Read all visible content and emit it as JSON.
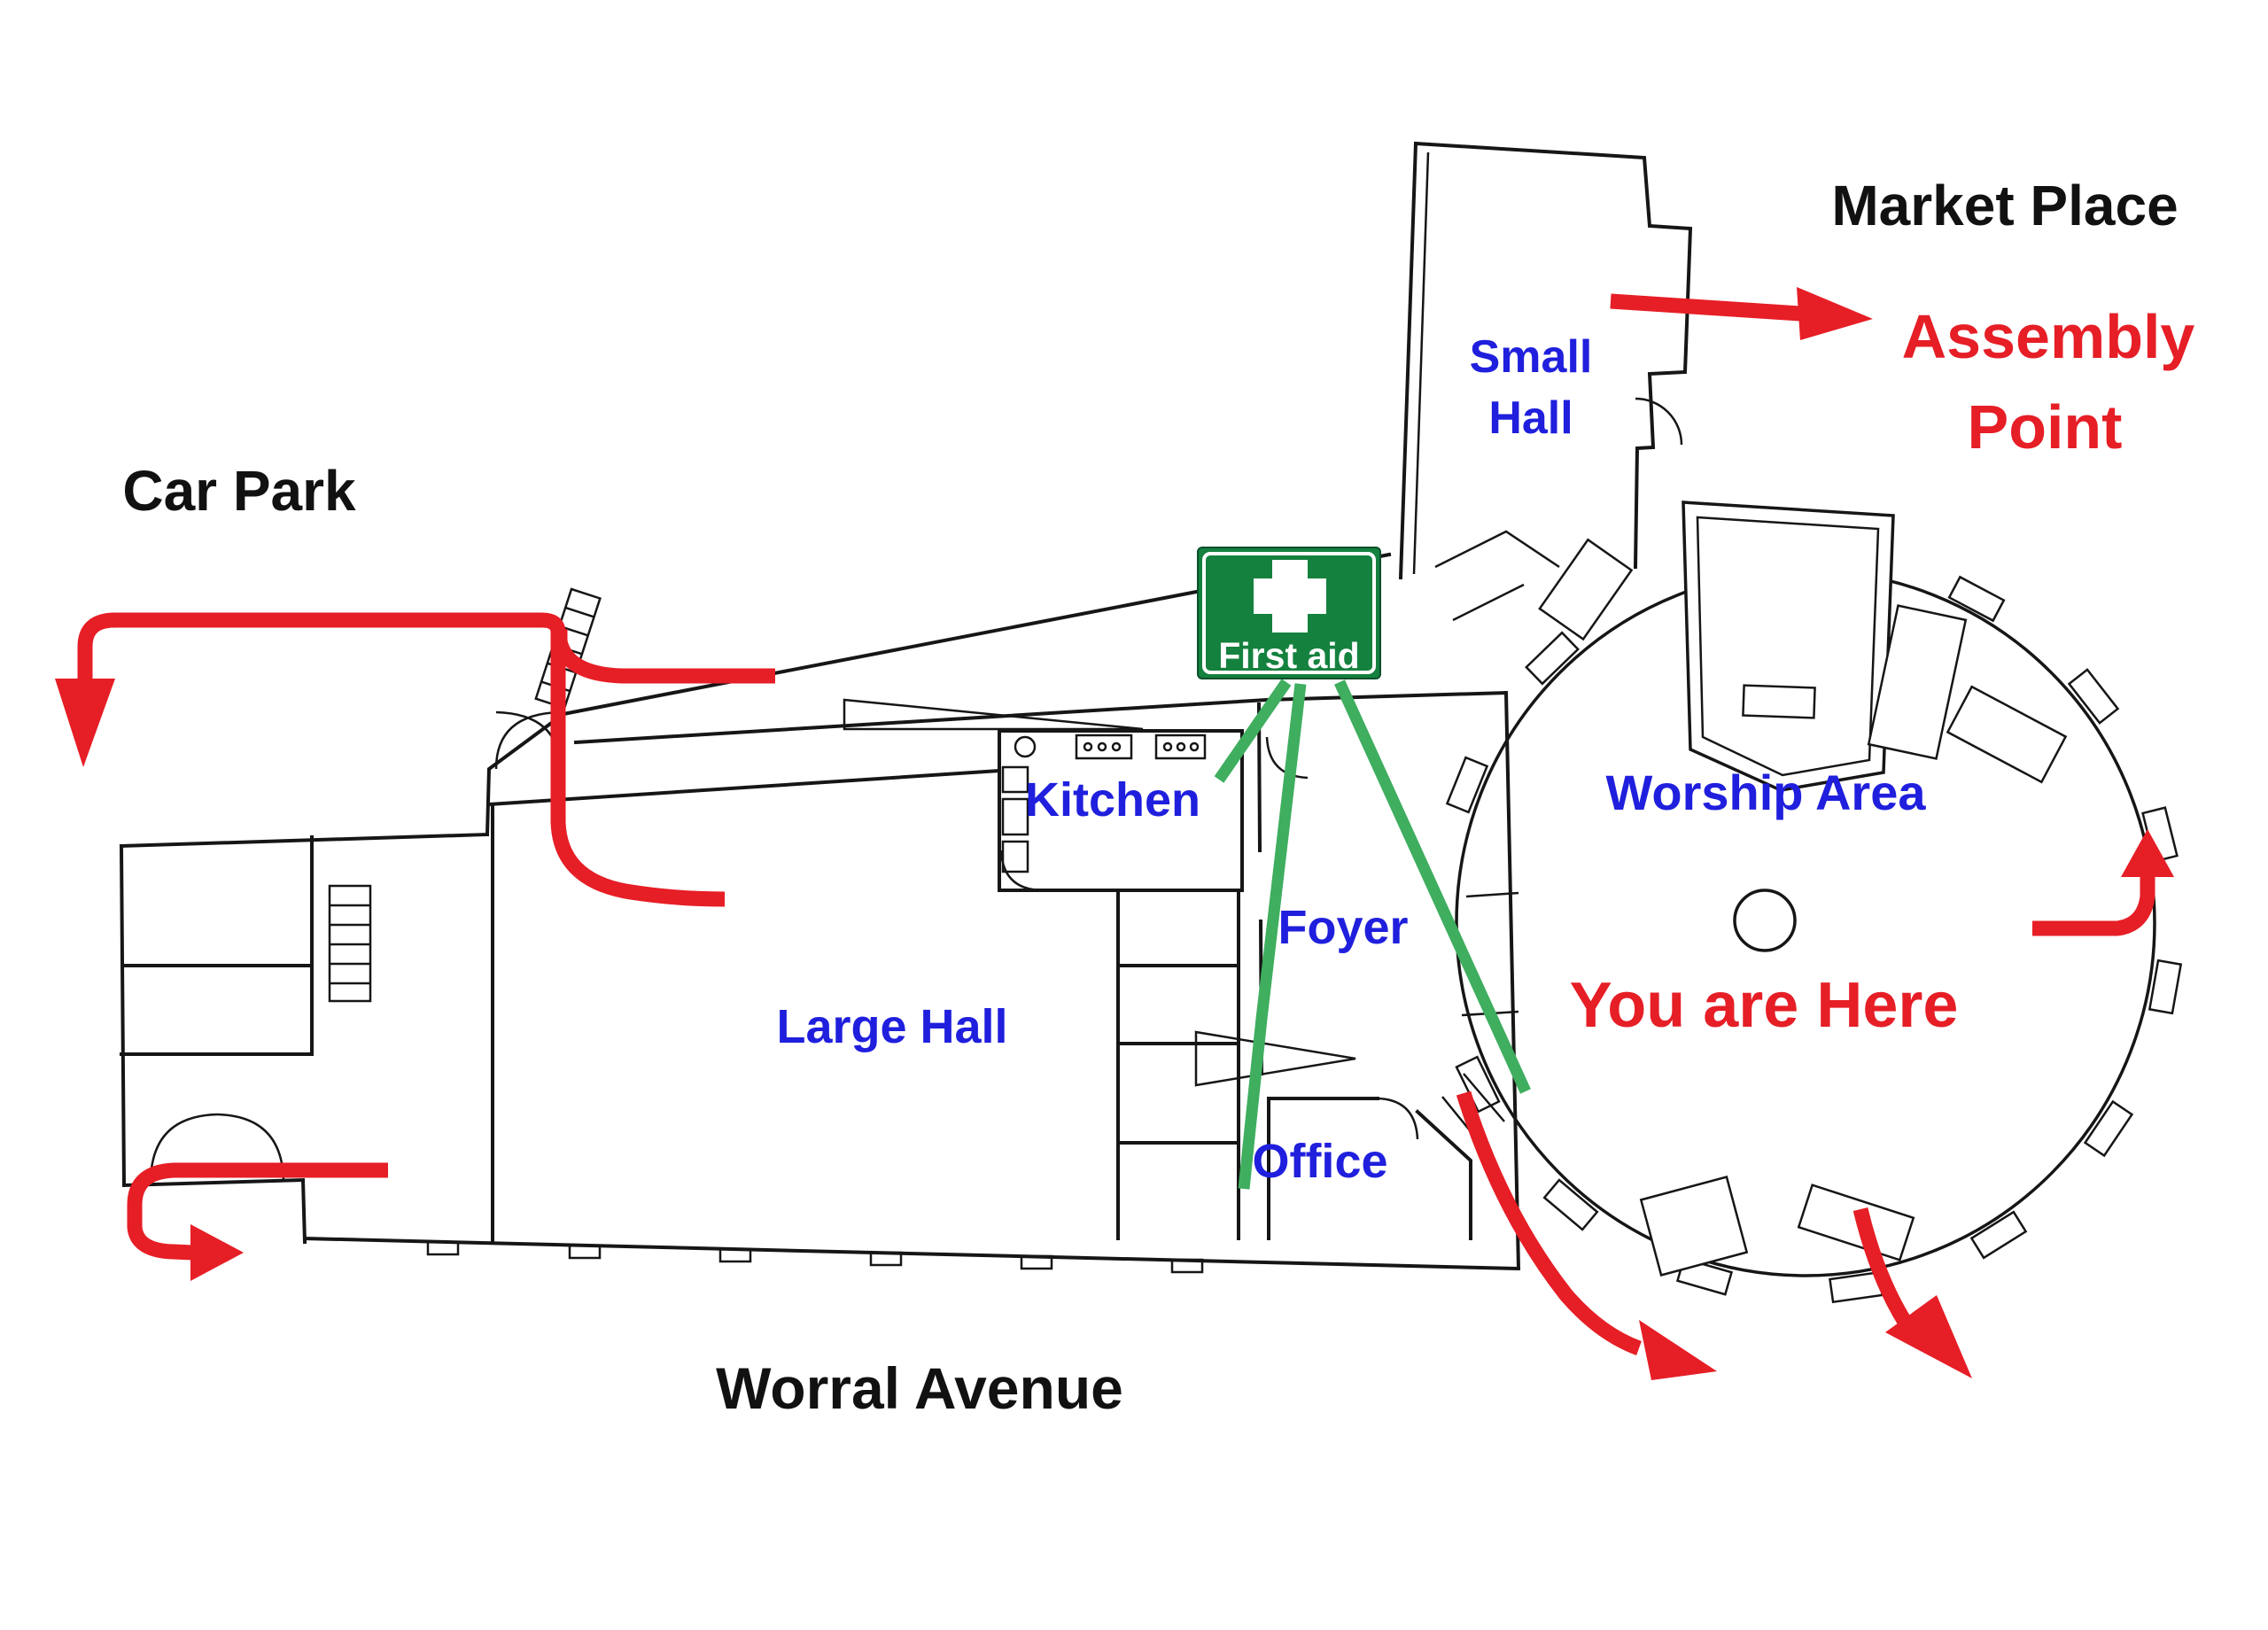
{
  "map_title_context": {
    "type": "evacuation-floor-plan"
  },
  "labels": {
    "market_place": "Market Place",
    "assembly_line1": "Assembly",
    "assembly_line2": "Point",
    "car_park": "Car Park",
    "small_hall_line1": "Small",
    "small_hall_line2": "Hall",
    "kitchen": "Kitchen",
    "foyer": "Foyer",
    "large_hall": "Large Hall",
    "worship_area": "Worship Area",
    "you_are_here": "You are Here",
    "office": "Office",
    "worral_avenue": "Worral Avenue",
    "first_aid": "First aid"
  },
  "colors": {
    "escape_route_red": "#e61e26",
    "room_label_blue": "#1f1fdd",
    "first_aid_sign_green": "#15813f",
    "first_aid_line_green": "#3fae5f",
    "wall_black": "#161616",
    "background": "#ffffff"
  },
  "icons": {
    "first_aid_cross": "white-cross",
    "evacuation_arrows": "red-arrow",
    "first_aid_location_lines": "green-line",
    "ladder": "ladder-steps"
  }
}
